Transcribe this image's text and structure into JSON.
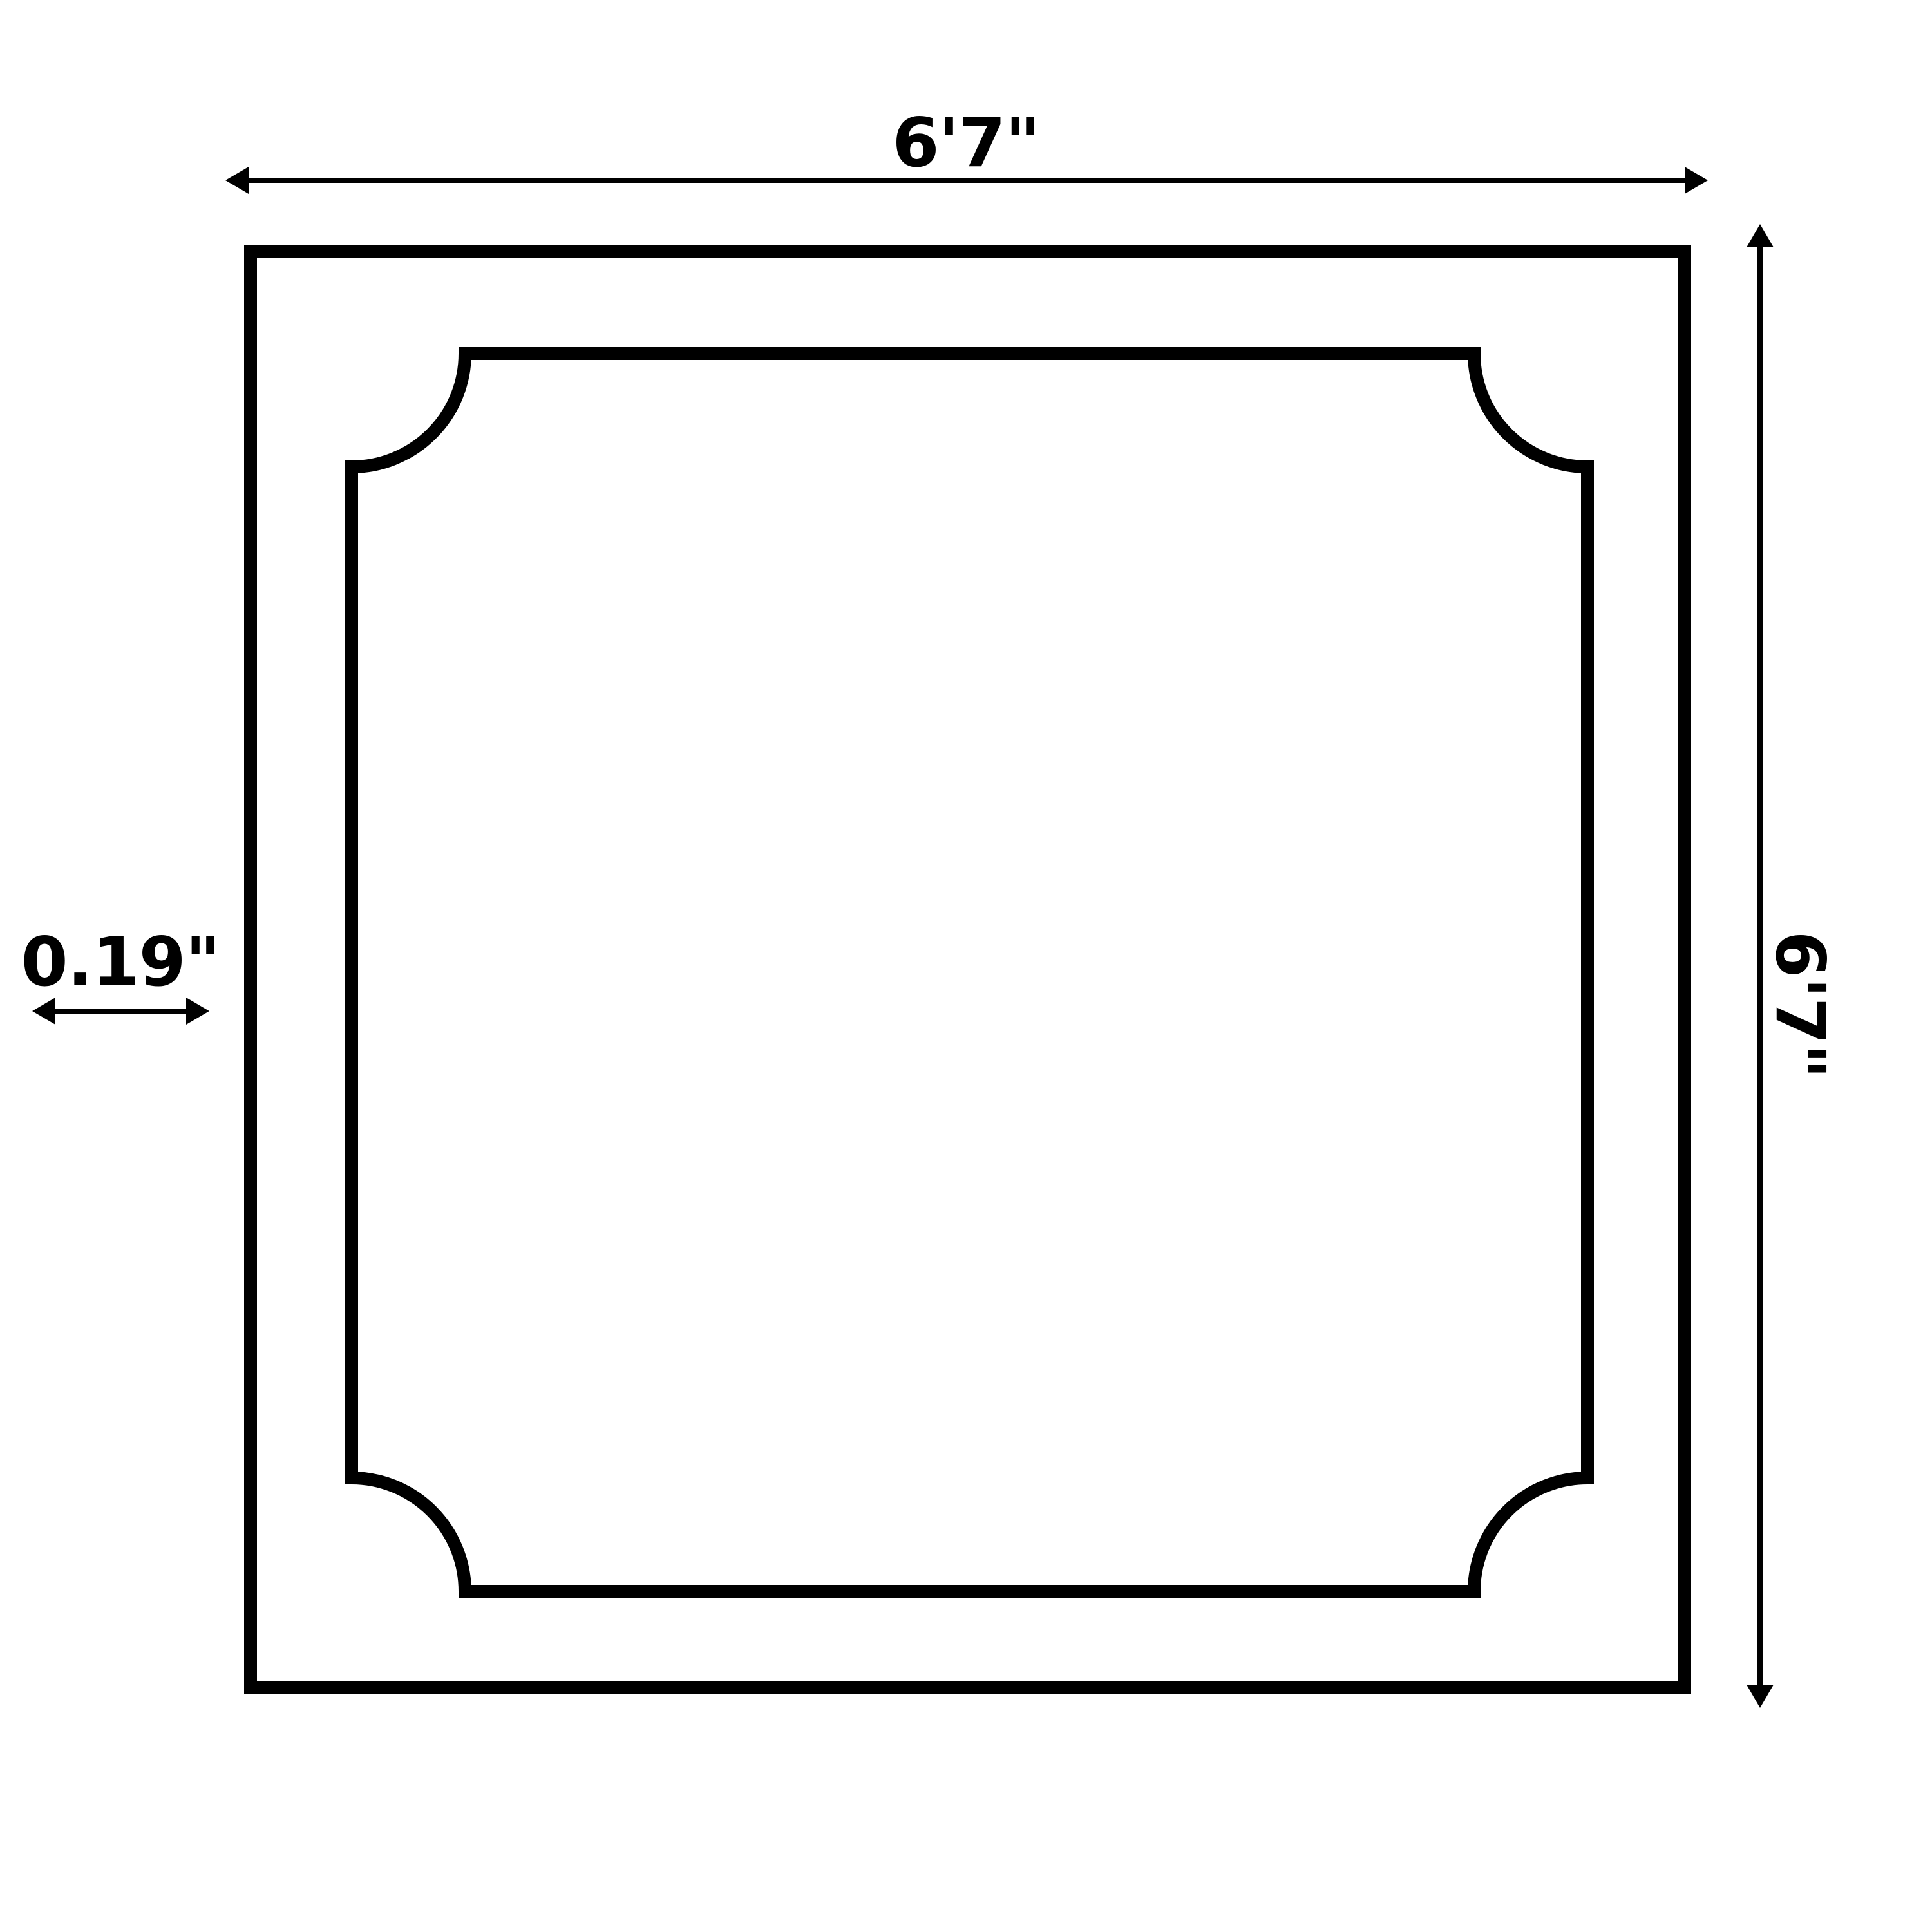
{
  "diagram": {
    "description": "Square panel dimension drawing with scooped-corner inner outline",
    "labels": {
      "width": "6'7\"",
      "height": "6'7\"",
      "thickness": "0.19\""
    },
    "colors": {
      "line": "#000000",
      "background": "#ffffff"
    }
  }
}
